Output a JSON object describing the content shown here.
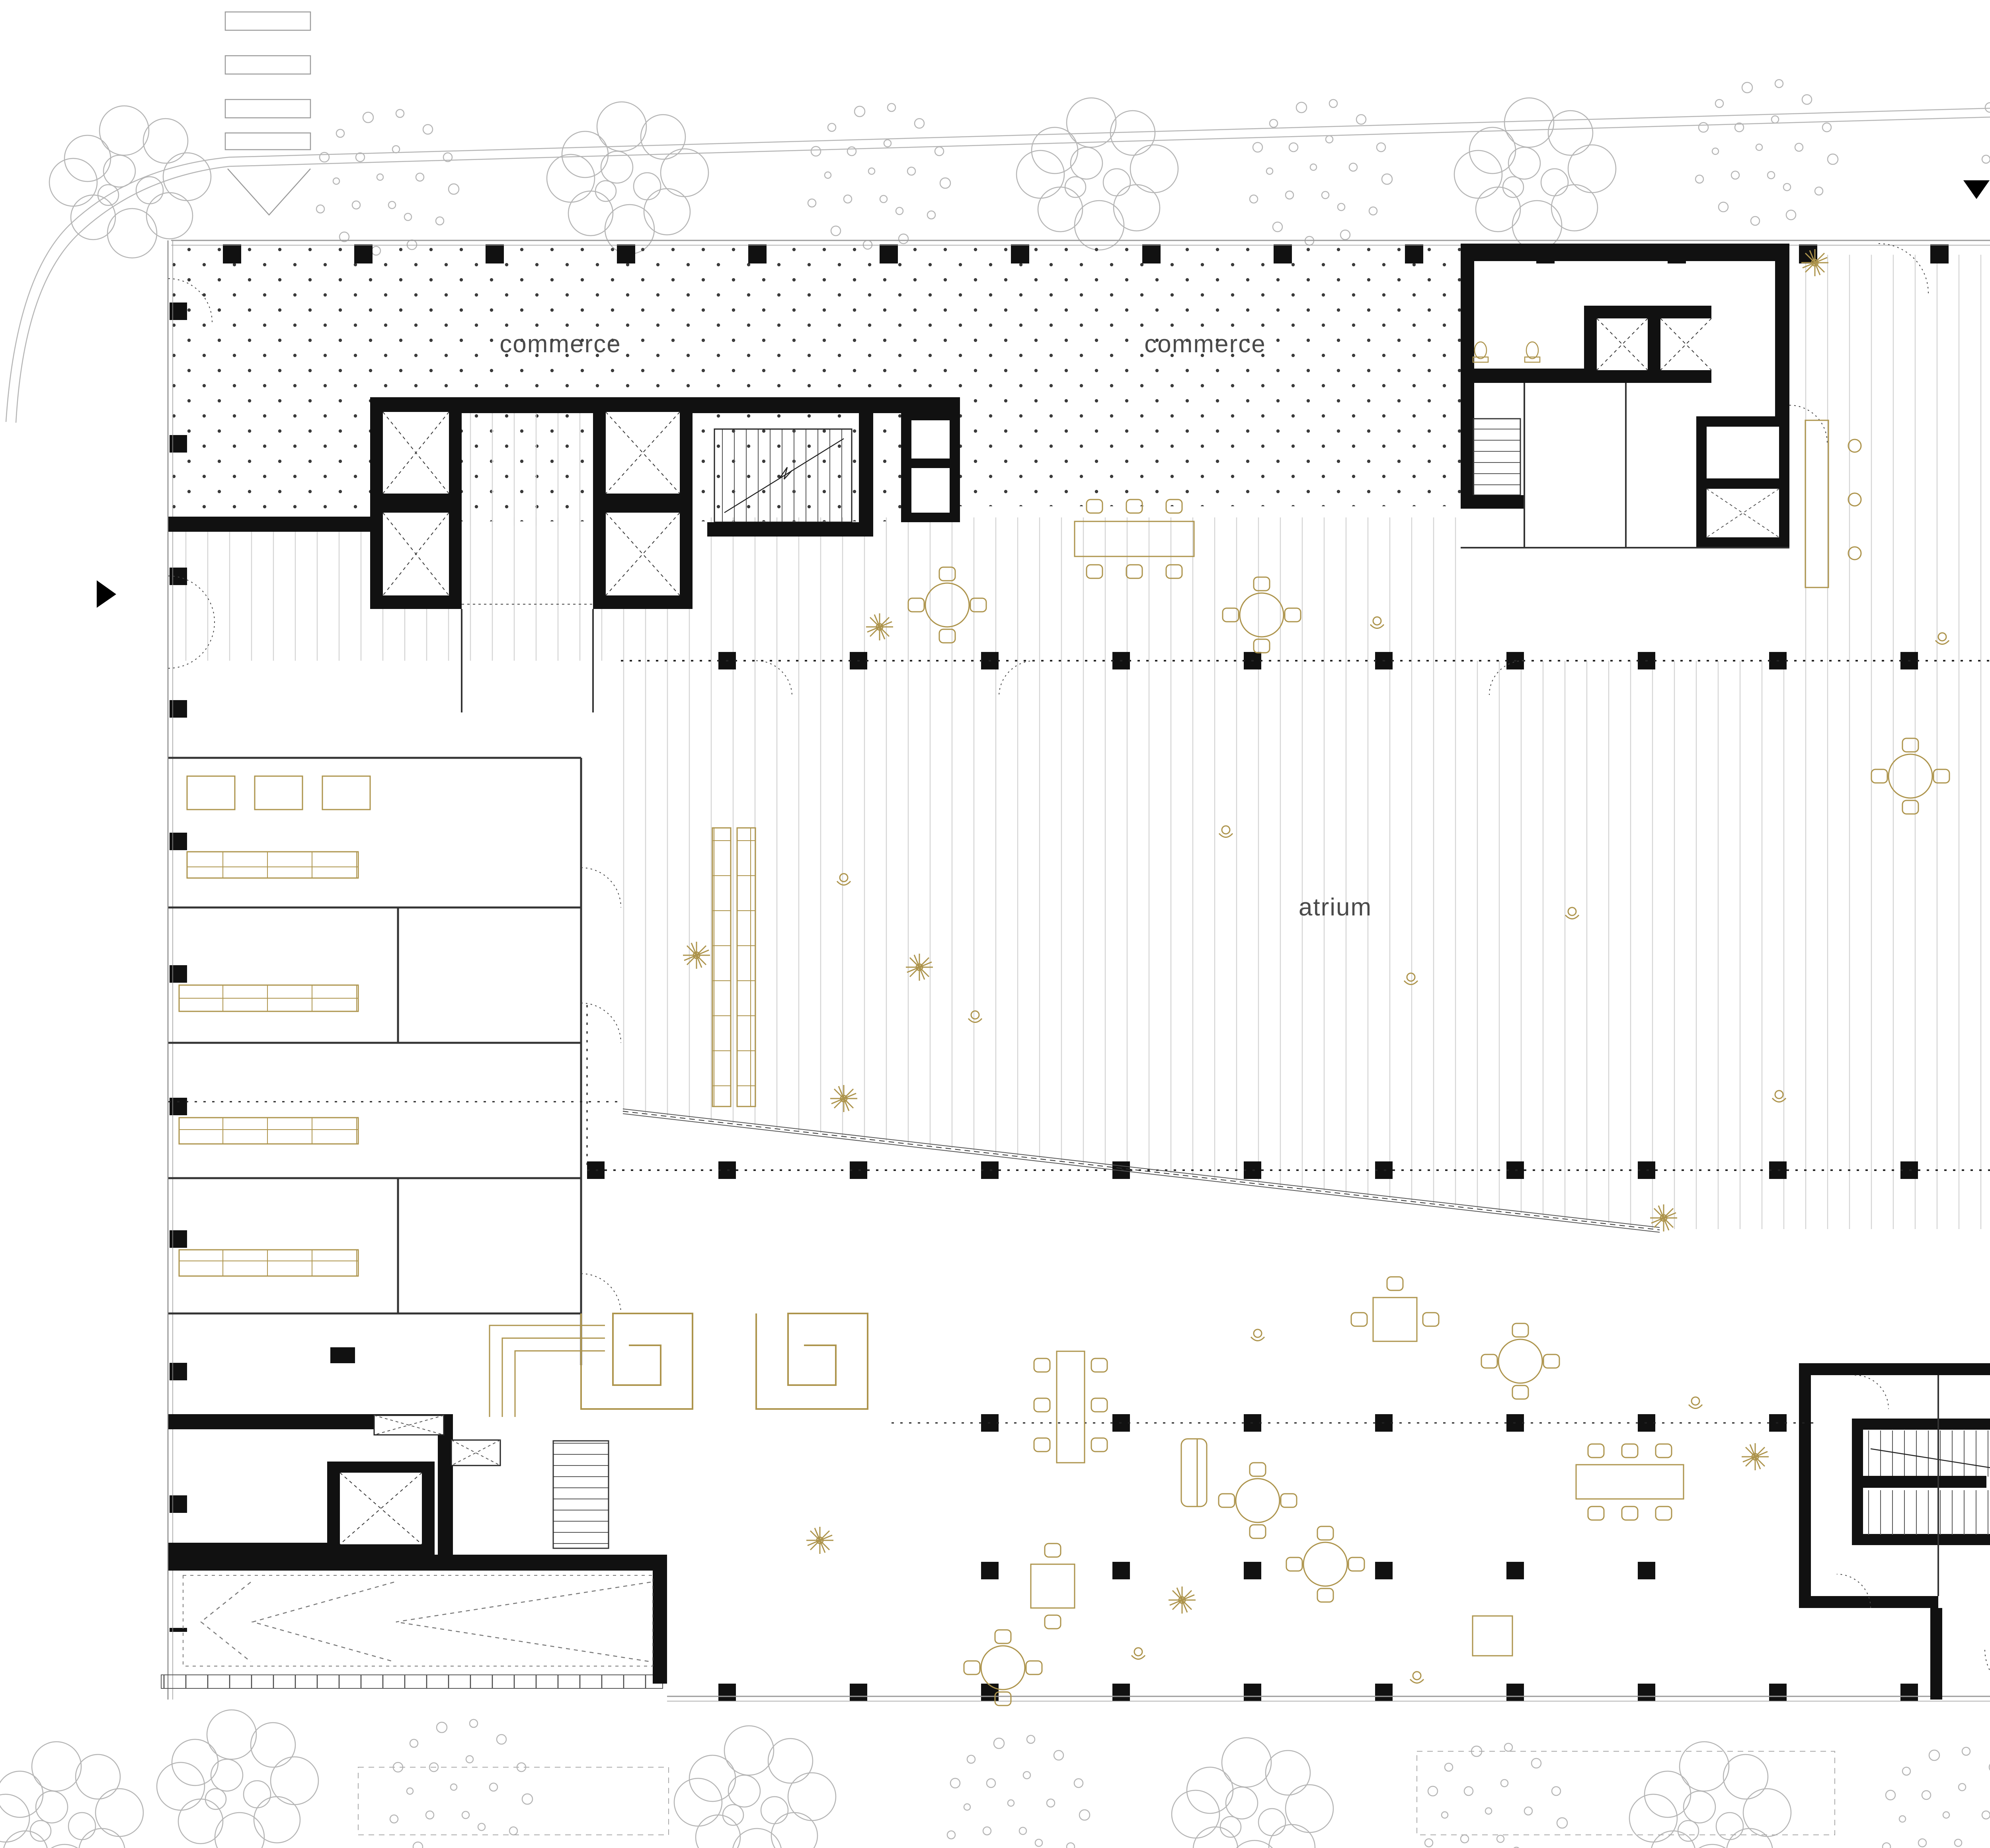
{
  "drawing": {
    "type": "architectural-floor-plan",
    "floor": "ground floor with atrium and commerce zones",
    "labels": {
      "commerce_top_left": "commerce",
      "commerce_top_center": "commerce",
      "commerce_right_upper": "commerce",
      "commerce_right_lower": "commerce",
      "atrium": "atrium"
    },
    "markers": {
      "top": "entrance-arrow-down",
      "left": "entrance-arrow-right",
      "bottom": "entrance-arrow-up"
    },
    "colors": {
      "furniture": "#ad944c",
      "walls": "#111111",
      "hatch_dot": "#3a3a3a",
      "wood_line": "#d4d4d4",
      "marker": "#000000",
      "label_text": "#4a4a4a",
      "landscape": "#b5b5b5"
    },
    "textures": {
      "commerce": "diagonal-dot-grid hatch",
      "atrium": "vertical-plank hatch"
    }
  }
}
